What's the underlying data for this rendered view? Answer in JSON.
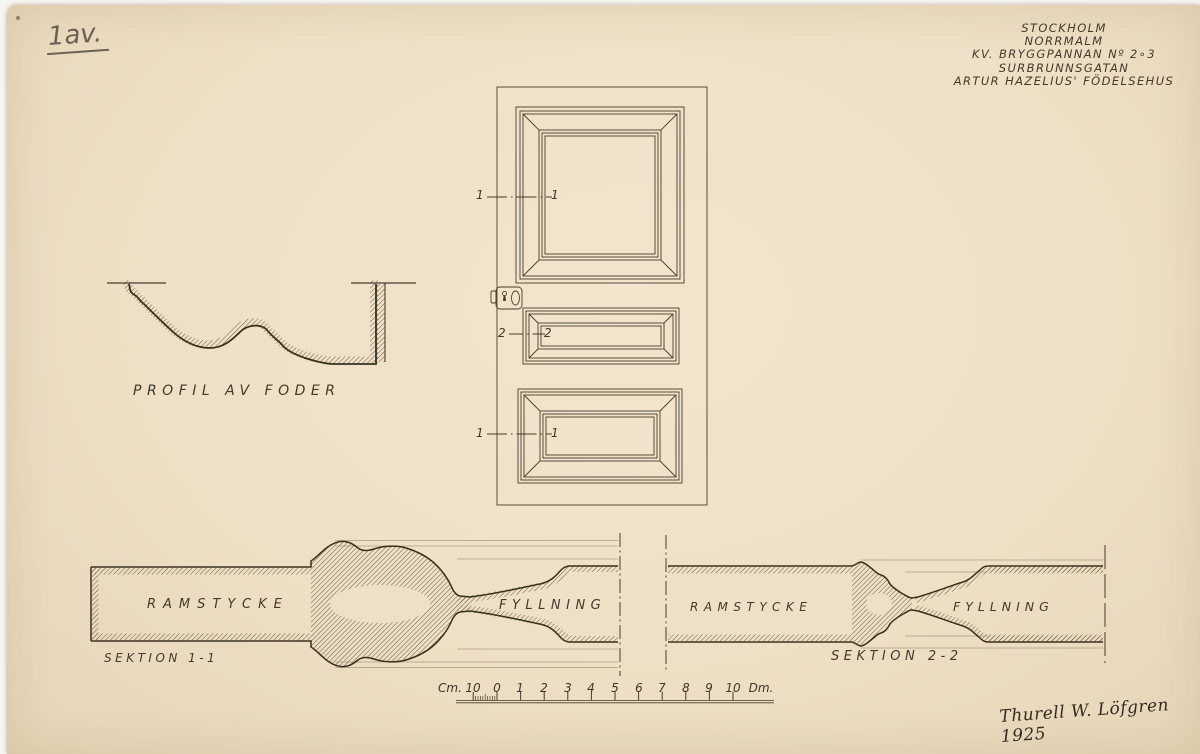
{
  "sheet": {
    "note": "1av.",
    "signature": "Thurell W. Löfgren 1925",
    "title_lines": [
      "STOCKHOLM",
      "NORRMALM",
      "KV. BRYGGPANNAN Nº 2∘3",
      "SURBRUNNSGATAN",
      "ARTUR HAZELIUS' FÖDELSEHUS"
    ]
  },
  "drawings": {
    "profile_label": "PROFIL AV FODER",
    "section1_label": "SEKTION 1-1",
    "section2_label": "SEKTION 2-2",
    "ramstycke_label": "RAMSTYCKE",
    "fyllning_label": "FYLLNING",
    "marker_1": "1",
    "marker_2": "2"
  },
  "scale_bar": {
    "unit_left": "Cm.",
    "unit_right": "Dm.",
    "marks": [
      "10",
      "0",
      "1",
      "2",
      "3",
      "4",
      "5",
      "6",
      "7",
      "8",
      "9",
      "10"
    ]
  },
  "colors": {
    "paper": "#eee0c6",
    "ink": "#3e362a",
    "pencil": "#6a6156"
  }
}
